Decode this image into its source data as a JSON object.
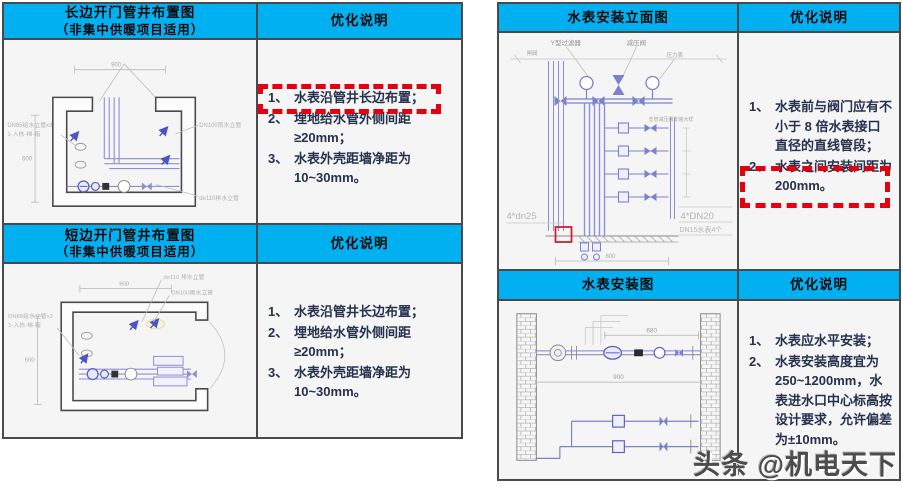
{
  "watermark": "头条 @机电天下",
  "colors": {
    "header_bg": "#00b0f0",
    "table_border": "#4a4a4a",
    "cell_bg": "#f5f5f6",
    "note_text": "#26314e",
    "highlight_red": "#e3000f",
    "pipe_blue": "#7b80cf",
    "diagram_gray": "#9a9a9a"
  },
  "left_table": {
    "row1": {
      "title": "长边开门管井布置图",
      "subtitle": "（非集中供暖项目适用）",
      "notes_title": "优化说明",
      "notes": [
        {
          "num": "1、",
          "text": "水表沿管井长边布置；"
        },
        {
          "num": "2、",
          "text": "埋地给水管外侧间距≥20mm；"
        },
        {
          "num": "3、",
          "text": "水表外壳距墙净距为 10~30mm。"
        }
      ],
      "diagram": {
        "label_left_1": "DN65给水立管x3",
        "label_left_2": "1-入栋-梯-箱",
        "label_right_top": "DN100雨水立管",
        "label_right_bottom": "de110排水立管",
        "dim_top": "900",
        "dim_left": "600"
      }
    },
    "row2": {
      "title": "短边开门管井布置图",
      "subtitle": "（非集中供暖项目适用）",
      "notes_title": "优化说明",
      "notes": [
        {
          "num": "1、",
          "text": "水表沿管井长边布置；"
        },
        {
          "num": "2、",
          "text": "埋地给水管外侧间距≥20mm；"
        },
        {
          "num": "3、",
          "text": "水表外壳距墙净距为 10~30mm。"
        }
      ],
      "diagram": {
        "label_left_1": "DN65给水立管x2",
        "label_left_2": "1-入栋-梯-箱",
        "label_right_top": "de110 排水立管",
        "label_right_bottom": "DN100雨水立管",
        "dim_top": "900",
        "dim_left": "600"
      }
    }
  },
  "right_table": {
    "row1": {
      "title": "水表安装立面图",
      "notes_title": "优化说明",
      "notes": [
        {
          "num": "1、",
          "text": "水表前与阀门应有不小于 8 倍水表接口直径的直线管段；"
        },
        {
          "num": "2、",
          "text": "水表之间安装间距为 200mm。"
        }
      ],
      "diagram": {
        "label_strainer": "Y型过滤器",
        "label_prv": "减压阀",
        "label_valve": "闸阀",
        "label_gauge": "压力表",
        "label_detail": "支管减压阀安装大样",
        "label_left_pipes": "4*dn25",
        "label_right_pipes": "4*DN20",
        "label_meters": "DN15水表4个",
        "dim_bottom": "800"
      }
    },
    "row2": {
      "title": "水表安装图",
      "notes_title": "优化说明",
      "notes": [
        {
          "num": "1、",
          "text": "水表应水平安装；"
        },
        {
          "num": "2、",
          "text": "水表安装高度宜为 250~1200mm，水表进水口中心标高按设计要求，允许偏差为±10mm。"
        }
      ],
      "diagram": {
        "dim_top": "680",
        "dim_bottom": "900"
      }
    }
  }
}
